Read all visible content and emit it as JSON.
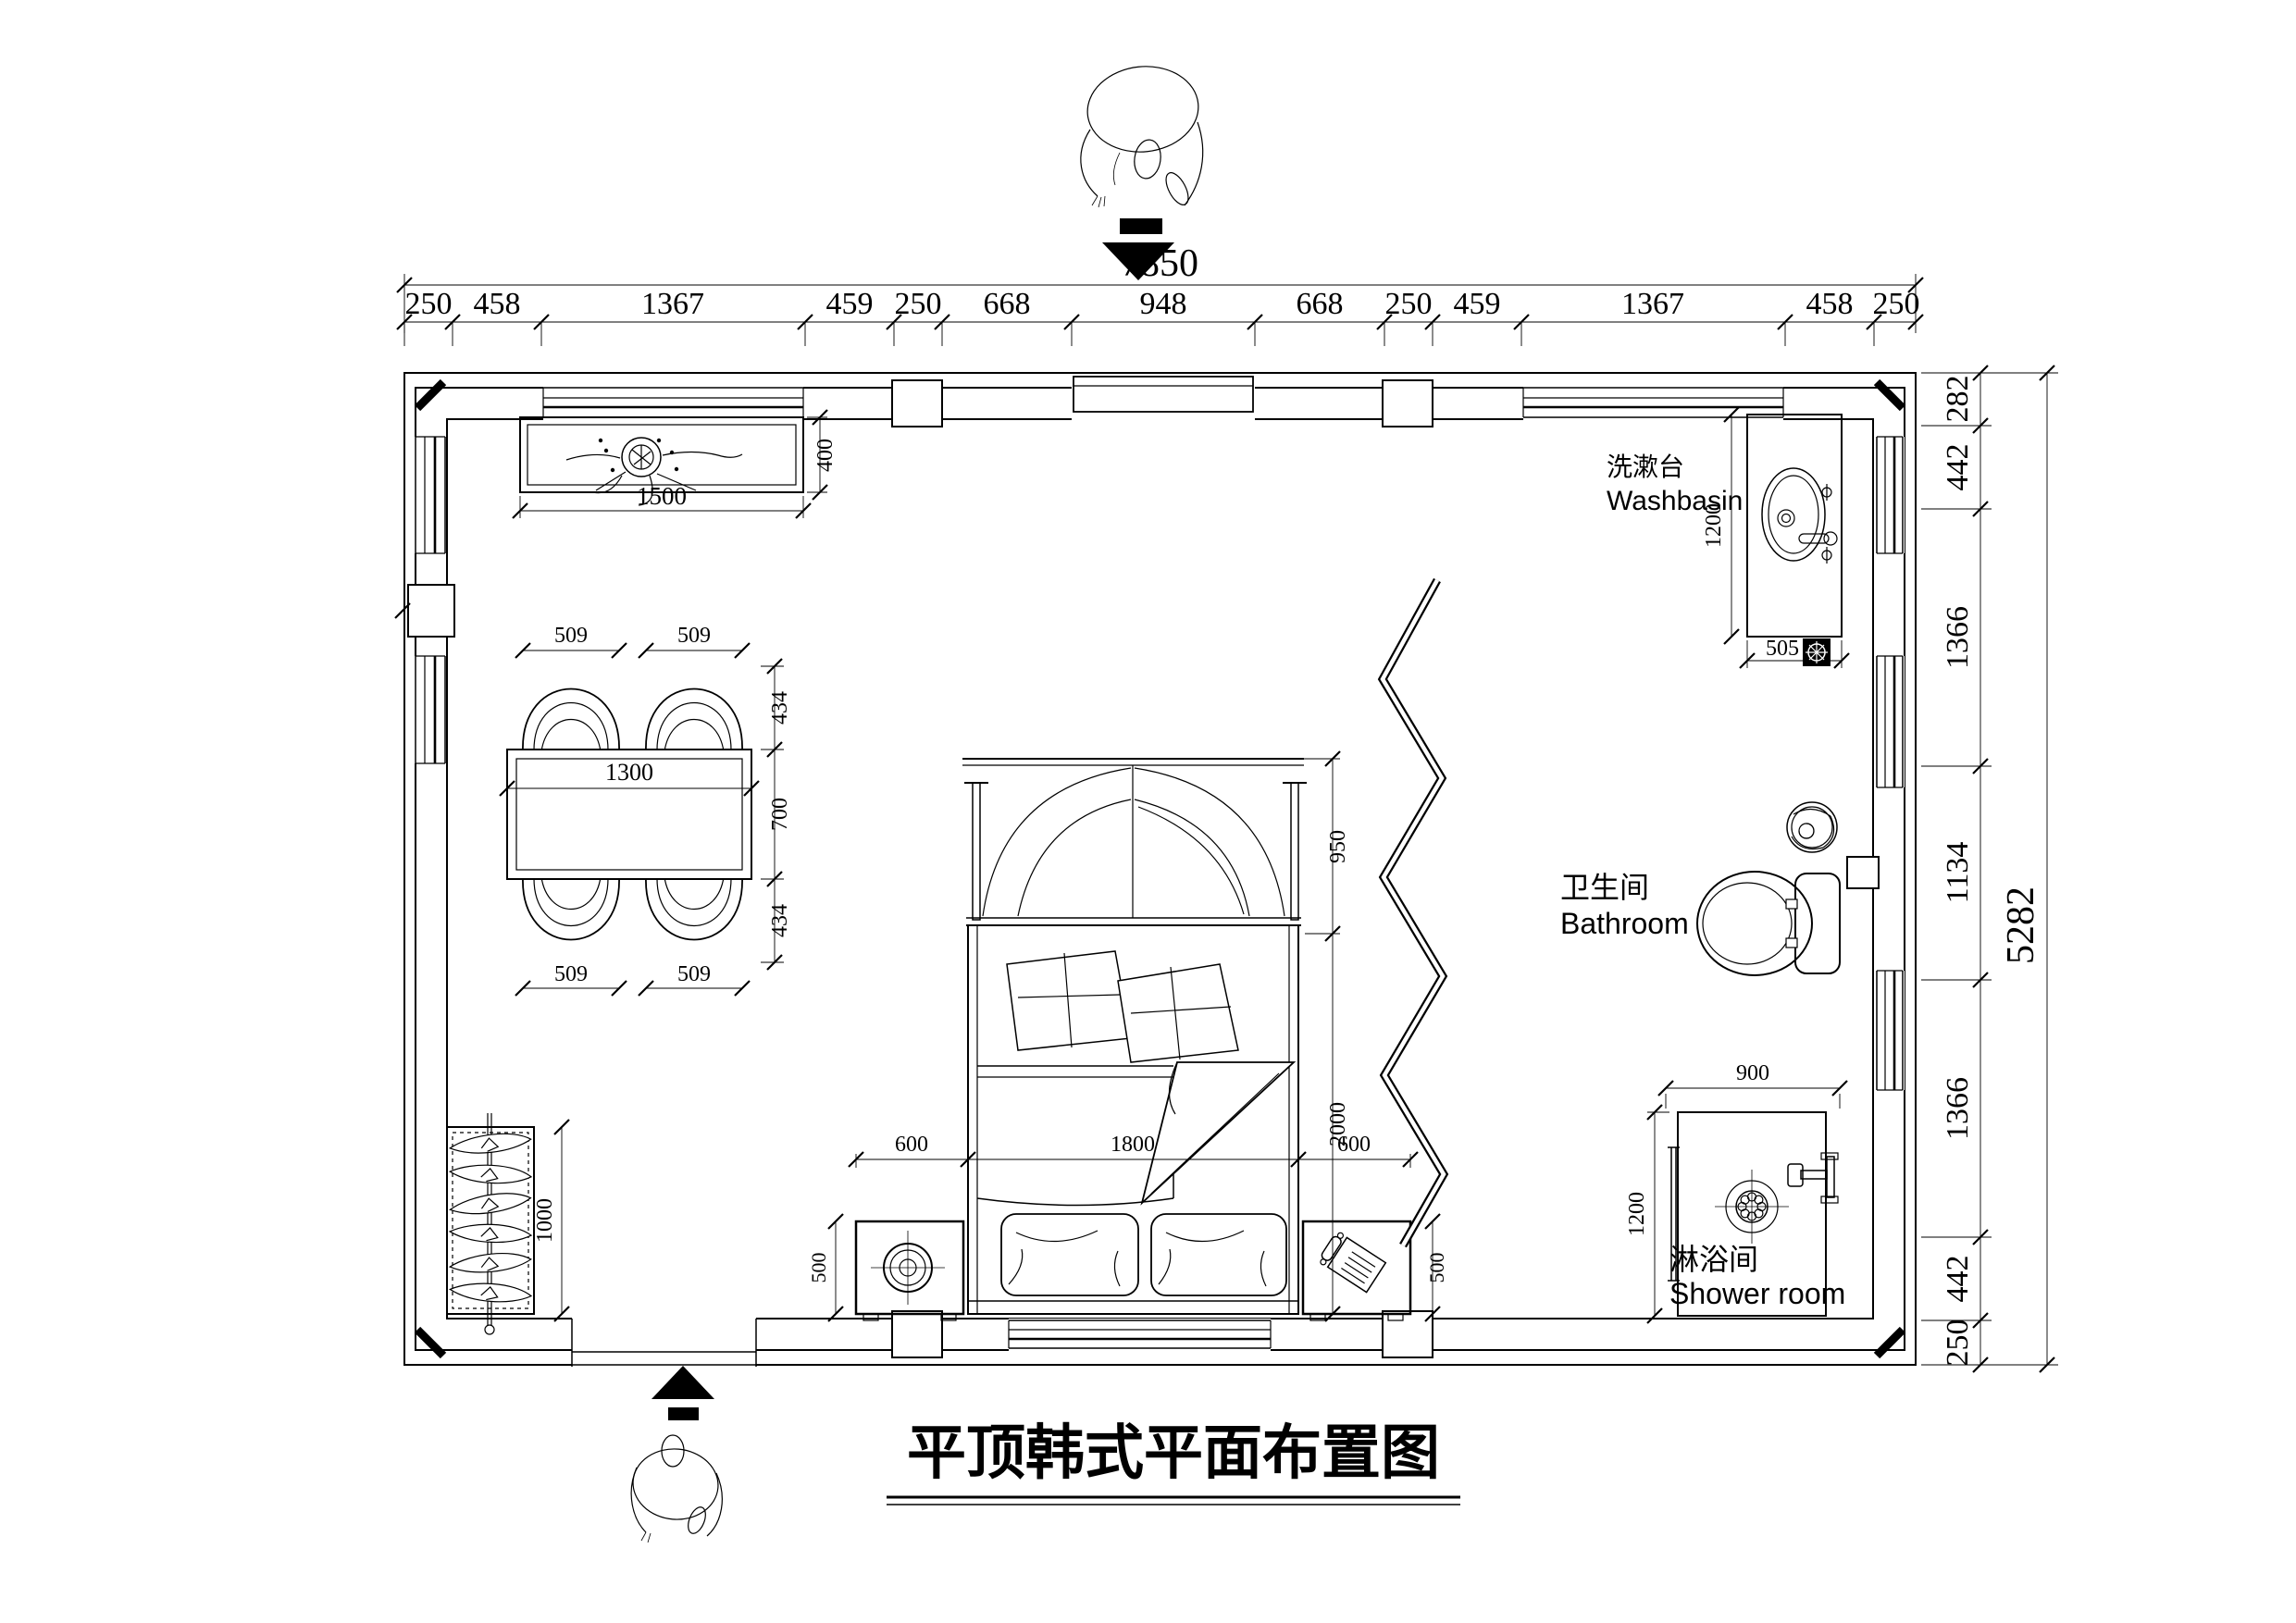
{
  "title": {
    "text": "平顶韩式平面布置图"
  },
  "labels": {
    "washbasin_zh": "洗漱台",
    "washbasin_en": "Washbasin",
    "bathroom_zh": "卫生间",
    "bathroom_en": "Bathroom",
    "shower_zh": "淋浴间",
    "shower_en": "Shower room"
  },
  "dimensions": {
    "top_total": "7850",
    "top_chain": [
      "250",
      "458",
      "1367",
      "459",
      "250",
      "668",
      "948",
      "668",
      "250",
      "459",
      "1367",
      "458",
      "250"
    ],
    "right_chain": [
      "282",
      "442",
      "1366",
      "1134",
      "1366",
      "442",
      "250"
    ],
    "right_total": "5282",
    "counter": {
      "length": "1500",
      "depth": "400"
    },
    "dining": {
      "chair_top": [
        "509",
        "509"
      ],
      "chair_bottom": [
        "509",
        "509"
      ],
      "table_length": "1300",
      "side": [
        "434",
        "700",
        "434"
      ]
    },
    "wardrobe": {
      "length": "1000"
    },
    "bed": {
      "canopy_depth": "950",
      "length": "2000",
      "row": [
        "600",
        "1800",
        "600"
      ],
      "nightstand_left_depth": "500",
      "nightstand_right_depth": "500"
    },
    "washbasin": {
      "counter_length": "1200",
      "counter_width": "505"
    },
    "shower": {
      "width": "900",
      "depth": "1200"
    }
  }
}
